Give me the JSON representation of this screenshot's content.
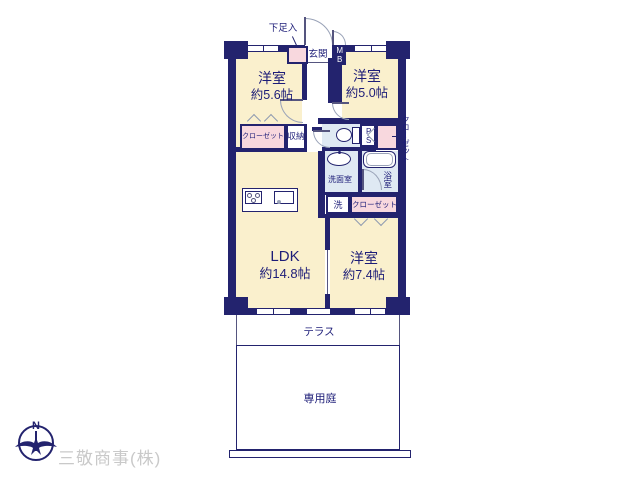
{
  "floorplan": {
    "rooms": [
      {
        "name": "洋室",
        "size": "約5.6帖"
      },
      {
        "name": "洋室",
        "size": "約5.0帖"
      },
      {
        "name": "LDK",
        "size": "約14.8帖"
      },
      {
        "name": "洋室",
        "size": "約7.4帖"
      }
    ],
    "labels": {
      "entrance": "玄関",
      "shoe_cabinet": "下足入",
      "meter_box": "MB",
      "pipe_space": "PS",
      "closet_a": "クローゼット",
      "storage": "収納",
      "closet_right": "クローゼット",
      "washroom": "洗面室",
      "bathroom": "浴室",
      "laundry": "洗",
      "closet_bottom": "クローゼット",
      "terrace": "テラス",
      "private_garden": "専用庭"
    },
    "compass": {
      "north": "N"
    },
    "footer": {
      "company": "三敬商事(株)"
    },
    "colors": {
      "wall": "#23236E",
      "room_fill": "#FAF0CD",
      "closet_fill": "#F8D8DE",
      "wet_fill": "#DFE9F3",
      "text": "#1D1D78",
      "door_arc": "#9AA3B8",
      "company_text": "#C9C9C9"
    }
  }
}
